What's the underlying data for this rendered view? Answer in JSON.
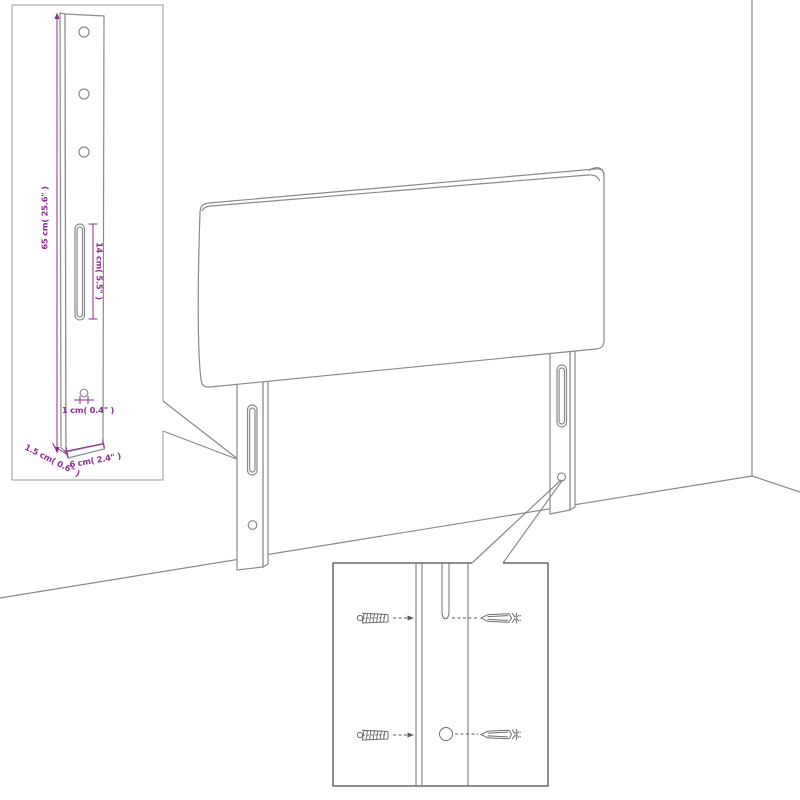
{
  "diagram_labels": {
    "leg_height": "65 cm( 25.6\" )",
    "slot_length": "14 cm( 5.5\" )",
    "hole_size": "1 cm( 0.4\" )",
    "leg_thickness": "1.5 cm( 0.6\" )",
    "leg_width": "6 cm( 2.4\" )"
  },
  "colors": {
    "dimension_text": "#8e2f8e",
    "drawing_line": "#8a8a8a",
    "inset_border_dark": "#4d4d4d",
    "background": "#ffffff"
  }
}
